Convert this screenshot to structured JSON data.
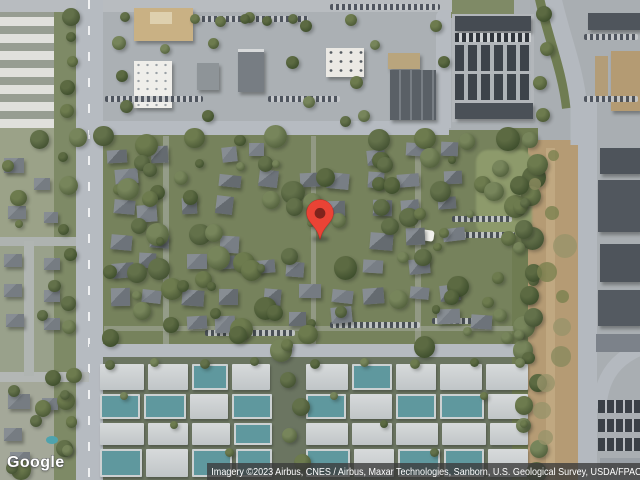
{
  "map": {
    "view_type": "satellite imagery",
    "provider_logo": "Google",
    "attribution": "Imagery ©2023 Airbus, CNES / Airbus, Maxar Technologies, Sanborn, U.S. Geological Survey, USDA/FPAC/GEO",
    "marker": {
      "color": "#EA4335",
      "stroke_color": "#C5221F",
      "inner_color": "#7F231C"
    }
  }
}
